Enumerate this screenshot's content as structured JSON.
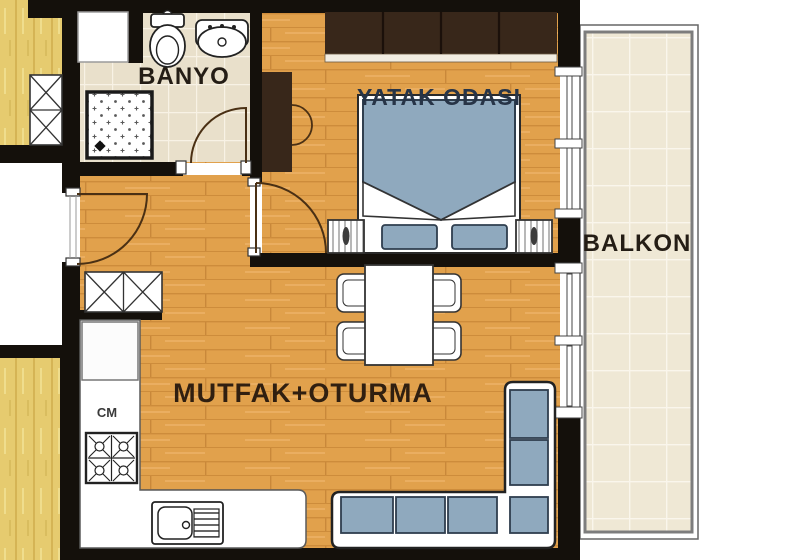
{
  "plan": {
    "title": "apartment-floor-plan",
    "rooms": {
      "bathroom": {
        "label": "BANYO",
        "furniture": [
          "toilet",
          "washbasin",
          "shower-tray",
          "utility-niche"
        ]
      },
      "bedroom": {
        "label": "YATAK ODASI",
        "furniture": [
          "double-bed",
          "pillow",
          "pillow",
          "nightstand",
          "nightstand",
          "wardrobe",
          "closet"
        ]
      },
      "balcony": {
        "label": "BALKON",
        "furniture": []
      },
      "living_kitchen": {
        "label": "MUTFAK+OTURMA",
        "furniture": [
          "dining-table",
          "chair",
          "chair",
          "chair",
          "chair",
          "corner-sofa",
          "kitchen-counter",
          "sink",
          "stove",
          "refrigerator",
          "washing-machine",
          "shoe-cabinet"
        ]
      }
    },
    "appliances": {
      "washing_machine_label": "CM"
    },
    "colors": {
      "wall": "#14100b",
      "wood_floor": "#e1a14c",
      "wood_side": "#e6cb6f",
      "bath_tile": "#e9e0cb",
      "balcony_tile": "#efe8d5",
      "cushion_blue": "#8fa9be",
      "cushion_border": "#2f3e4e",
      "wardrobe_brown": "#38271a",
      "fixture_white": "#ffffff",
      "door_arc": "#4a3014",
      "label_dark": "#241d15",
      "label_navy": "#273447"
    }
  }
}
